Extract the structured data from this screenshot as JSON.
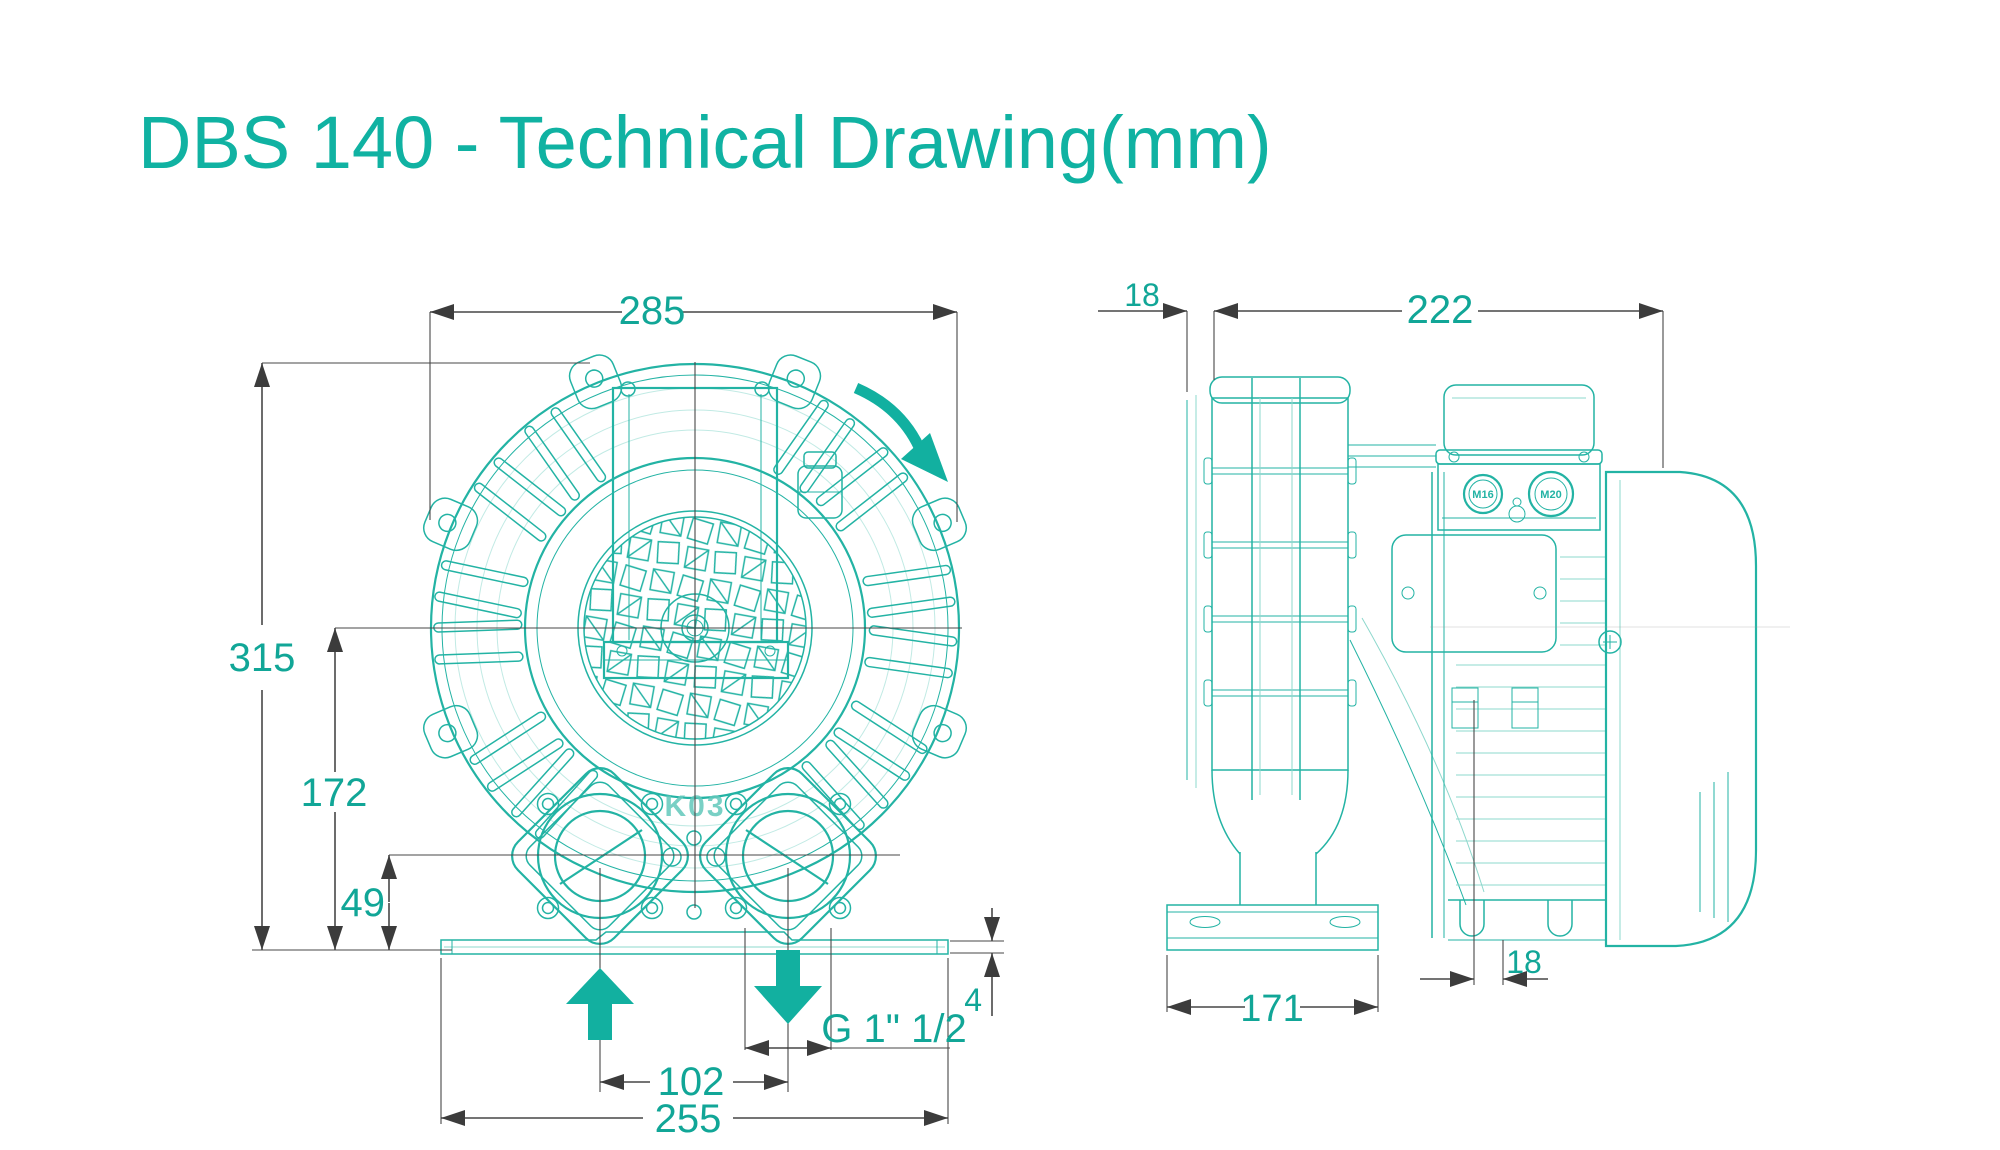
{
  "title": "DBS 140 - Technical Drawing(mm)",
  "colors": {
    "accent": "#12b0a0",
    "drawing_line": "#23b3a4",
    "dimension_line": "#474747",
    "background": "#ffffff"
  },
  "front_view": {
    "dims": {
      "overall_width": "285",
      "overall_height": "315",
      "axis_height": "172",
      "port_axis_height": "49",
      "port_spacing": "102",
      "base_length": "255",
      "base_thickness": "4",
      "port_thread": "G 1\" 1/2"
    },
    "labels": {
      "casting_mark": "K03"
    },
    "icons": [
      "rotation-direction-arrow",
      "inlet-up-arrow",
      "outlet-down-arrow"
    ]
  },
  "side_view": {
    "dims": {
      "front_overhang": "18",
      "body_length": "222",
      "foot_length": "171",
      "rear_overhang": "18"
    },
    "labels": {
      "cable_gland_small": "M16",
      "cable_gland_large": "M20"
    }
  }
}
